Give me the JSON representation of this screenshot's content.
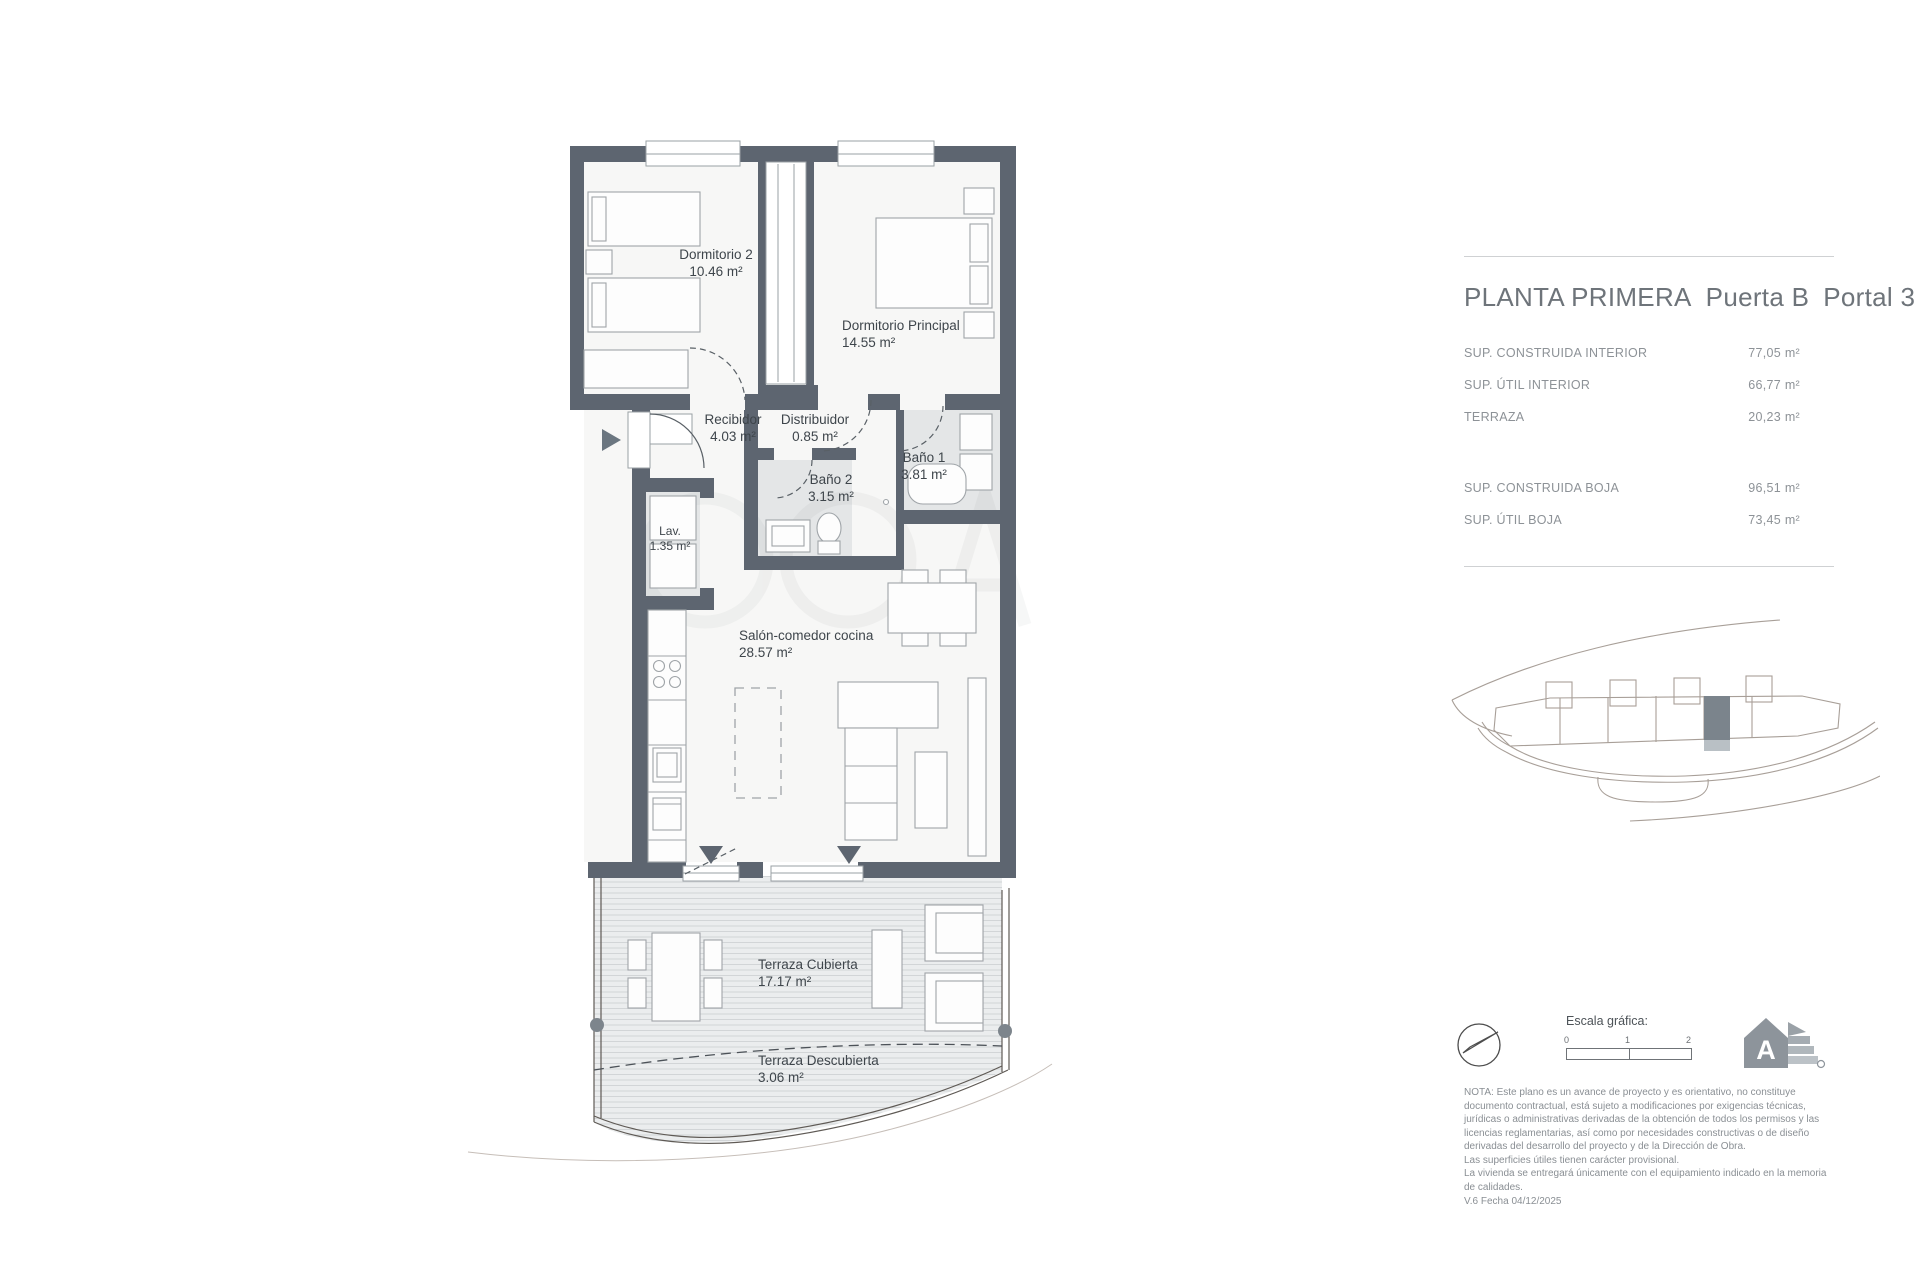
{
  "panel": {
    "title": {
      "part1": "PLANTA PRIMERA",
      "part2": "Puerta B",
      "part3": "Portal 3"
    },
    "surfaces": [
      {
        "label": "SUP. CONSTRUIDA INTERIOR",
        "value": "77,05 m²"
      },
      {
        "label": "SUP. ÚTIL INTERIOR",
        "value": "66,77 m²"
      },
      {
        "label": "TERRAZA",
        "value": "20,23 m²"
      },
      {
        "label": "SUP. CONSTRUIDA BOJA",
        "value": "96,51 m²"
      },
      {
        "label": "SUP. ÚTIL BOJA",
        "value": "73,45 m²"
      }
    ],
    "scale": {
      "label": "Escala gráfica:",
      "ticks": [
        "0",
        "1",
        "2"
      ]
    },
    "notes": {
      "lines": [
        "NOTA: Este plano es un avance de proyecto y es orientativo, no constituye",
        "documento contractual, está sujeto a modificaciones por exigencias técnicas,",
        "jurídicas o administrativas derivadas de la obtención de todos los permisos y las",
        "licencias reglamentarias, así como por necesidades constructivas o de diseño",
        "derivadas del desarrollo del proyecto y de la Dirección de Obra.",
        "Las superficies útiles tienen carácter provisional.",
        "La vivienda se entregará únicamente con el equipamiento indicado en la memoria",
        "de calidades."
      ]
    },
    "version": "V.6 Fecha 04/12/2025",
    "energy_rating_letter": "A"
  },
  "plan": {
    "rooms": [
      {
        "name": "Dormitorio 2",
        "area": "10.46 m²"
      },
      {
        "name": "Dormitorio Principal",
        "area": "14.55 m²"
      },
      {
        "name": "Recibidor",
        "area": "4.03 m²"
      },
      {
        "name": "Distribuidor",
        "area": "0.85 m²"
      },
      {
        "name": "Baño 1",
        "area": "3.81 m²"
      },
      {
        "name": "Baño 2",
        "area": "3.15 m²"
      },
      {
        "name": "Lav.",
        "area": "1.35 m²"
      },
      {
        "name": "Salón-comedor cocina",
        "area": "28.57 m²"
      },
      {
        "name": "Terraza Cubierta",
        "area": "17.17 m²"
      },
      {
        "name": "Terraza Descubierta",
        "area": "3.06 m²"
      }
    ]
  },
  "colors": {
    "wall": "#5d6570",
    "bath_floor": "#e4e6e7",
    "terrace_fill": "#ebedee",
    "highlight_unit": "#7b848c",
    "keyplan_stroke": "#a89f98",
    "text_gray": "#8d9297"
  }
}
